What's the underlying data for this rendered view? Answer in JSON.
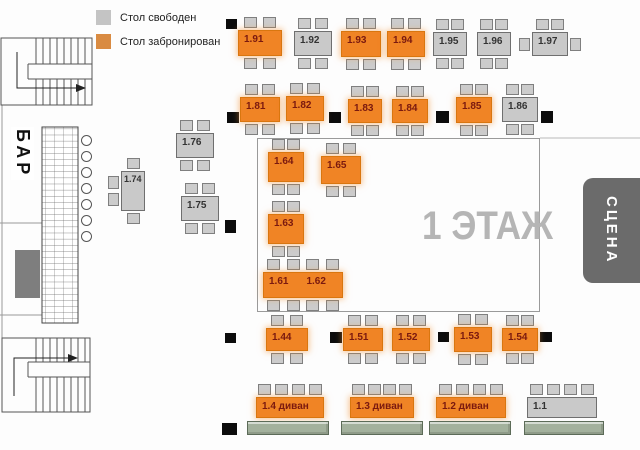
{
  "legend": {
    "free_label": "Стол свободен",
    "booked_label": "Стол забронирован"
  },
  "floor_label": "1 ЭТАЖ",
  "stage_label": "СЦЕНА",
  "bar": {
    "label": "БАР",
    "stool_x": 86,
    "stools": [
      140,
      156,
      172,
      188,
      204,
      220,
      236
    ]
  },
  "colors": {
    "booked_table": "#f08425",
    "free_table": "#c9c9c9",
    "legend_free": "#c4c4c4",
    "legend_booked": "#d98b42",
    "chair": "#cccccc",
    "pillar": "#0c0c0c",
    "stage_bg": "#6b6b6b",
    "stage_text": "#ffffff",
    "sofa": "#a3b19d",
    "floor_label_color": "#b5b5b5",
    "booked_label_text": "#7a190f",
    "free_label_text": "#333333"
  },
  "statuses": {
    "free": "free",
    "booked": "booked"
  },
  "tables": [
    {
      "label": "1.91",
      "status": "booked",
      "x": 238,
      "y": 30,
      "w": 44,
      "h": 26,
      "chairs": {
        "top": 2,
        "bottom": 2
      }
    },
    {
      "label": "1.92",
      "status": "free",
      "x": 294,
      "y": 31,
      "w": 38,
      "h": 25,
      "chairs": {
        "top": 2,
        "bottom": 2
      }
    },
    {
      "label": "1.93",
      "status": "booked",
      "x": 341,
      "y": 31,
      "w": 40,
      "h": 26,
      "chairs": {
        "top": 2,
        "bottom": 2
      }
    },
    {
      "label": "1.94",
      "status": "booked",
      "x": 387,
      "y": 31,
      "w": 38,
      "h": 26,
      "chairs": {
        "top": 2,
        "bottom": 2
      }
    },
    {
      "label": "1.95",
      "status": "free",
      "x": 433,
      "y": 32,
      "w": 34,
      "h": 24,
      "chairs": {
        "top": 2,
        "bottom": 2
      }
    },
    {
      "label": "1.96",
      "status": "free",
      "x": 477,
      "y": 32,
      "w": 34,
      "h": 24,
      "chairs": {
        "top": 2,
        "bottom": 2
      }
    },
    {
      "label": "1.97",
      "status": "free",
      "x": 532,
      "y": 32,
      "w": 36,
      "h": 24,
      "chairs": {
        "top": 2,
        "left": 1,
        "right": 1
      }
    },
    {
      "label": "1.81",
      "status": "booked",
      "x": 240,
      "y": 97,
      "w": 40,
      "h": 25,
      "chairs": {
        "top": 2,
        "bottom": 2
      }
    },
    {
      "label": "1.82",
      "status": "booked",
      "x": 286,
      "y": 96,
      "w": 38,
      "h": 25,
      "chairs": {
        "top": 2,
        "bottom": 2
      }
    },
    {
      "label": "1.83",
      "status": "booked",
      "x": 348,
      "y": 99,
      "w": 34,
      "h": 24,
      "chairs": {
        "top": 2,
        "bottom": 2
      }
    },
    {
      "label": "1.84",
      "status": "booked",
      "x": 392,
      "y": 99,
      "w": 36,
      "h": 24,
      "chairs": {
        "top": 2,
        "bottom": 2
      }
    },
    {
      "label": "1.85",
      "status": "booked",
      "x": 456,
      "y": 97,
      "w": 36,
      "h": 26,
      "chairs": {
        "top": 2,
        "bottom": 2
      }
    },
    {
      "label": "1.86",
      "status": "free",
      "x": 502,
      "y": 97,
      "w": 36,
      "h": 25,
      "chairs": {
        "top": 2,
        "bottom": 2
      }
    },
    {
      "label": "1.76",
      "status": "free",
      "x": 176,
      "y": 133,
      "w": 38,
      "h": 25,
      "chairs": {
        "top": 2,
        "bottom": 2
      }
    },
    {
      "label": "1.74",
      "status": "free",
      "x": 121,
      "y": 171,
      "w": 24,
      "h": 40,
      "chairs": {
        "top": 1,
        "bottom": 1,
        "left": 2
      }
    },
    {
      "label": "1.75",
      "status": "free",
      "x": 181,
      "y": 196,
      "w": 38,
      "h": 25,
      "chairs": {
        "top": 2,
        "bottom": 2
      }
    },
    {
      "label": "1.64",
      "status": "booked",
      "x": 268,
      "y": 152,
      "w": 36,
      "h": 30,
      "chairs": {
        "top": 2,
        "bottom": 2
      }
    },
    {
      "label": "1.65",
      "status": "booked",
      "x": 321,
      "y": 156,
      "w": 40,
      "h": 28,
      "chairs": {
        "top": 2,
        "bottom": 2
      }
    },
    {
      "label": "1.63",
      "status": "booked",
      "x": 268,
      "y": 214,
      "w": 36,
      "h": 30,
      "chairs": {
        "top": 2,
        "bottom": 2
      }
    },
    {
      "labels": [
        "1.61",
        "1.62"
      ],
      "status": "booked",
      "x": 263,
      "y": 272,
      "w": 80,
      "h": 26,
      "chairs": {
        "top": 4,
        "bottom": 4
      }
    },
    {
      "label": "1.44",
      "status": "booked",
      "x": 266,
      "y": 328,
      "w": 42,
      "h": 23,
      "chairs": {
        "top": 2,
        "bottom": 2
      }
    },
    {
      "label": "1.51",
      "status": "booked",
      "x": 343,
      "y": 328,
      "w": 40,
      "h": 23,
      "chairs": {
        "top": 2,
        "bottom": 2
      }
    },
    {
      "label": "1.52",
      "status": "booked",
      "x": 392,
      "y": 328,
      "w": 38,
      "h": 23,
      "chairs": {
        "top": 2,
        "bottom": 2
      }
    },
    {
      "label": "1.53",
      "status": "booked",
      "x": 454,
      "y": 327,
      "w": 38,
      "h": 25,
      "chairs": {
        "top": 2,
        "bottom": 2
      }
    },
    {
      "label": "1.54",
      "status": "booked",
      "x": 502,
      "y": 328,
      "w": 36,
      "h": 23,
      "chairs": {
        "top": 2,
        "bottom": 2
      }
    },
    {
      "label": "1.4 диван",
      "status": "booked",
      "x": 256,
      "y": 397,
      "w": 68,
      "h": 21,
      "chairs": {
        "top": 4
      },
      "sofa": {
        "x": 247,
        "y": 421,
        "w": 82,
        "h": 14
      }
    },
    {
      "label": "1.3 диван",
      "status": "booked",
      "x": 350,
      "y": 397,
      "w": 64,
      "h": 21,
      "chairs": {
        "top": 4
      },
      "sofa": {
        "x": 341,
        "y": 421,
        "w": 82,
        "h": 14
      }
    },
    {
      "label": "1.2 диван",
      "status": "booked",
      "x": 436,
      "y": 397,
      "w": 70,
      "h": 21,
      "chairs": {
        "top": 4
      },
      "sofa": {
        "x": 429,
        "y": 421,
        "w": 82,
        "h": 14
      }
    },
    {
      "label": "1.1",
      "status": "free",
      "x": 527,
      "y": 397,
      "w": 70,
      "h": 21,
      "chairs": {
        "top": 4
      },
      "sofa": {
        "x": 524,
        "y": 421,
        "w": 80,
        "h": 14
      }
    }
  ],
  "pillars": [
    {
      "x": 226,
      "y": 19,
      "w": 11,
      "h": 10
    },
    {
      "x": 227,
      "y": 112,
      "w": 12,
      "h": 11
    },
    {
      "x": 329,
      "y": 112,
      "w": 12,
      "h": 11
    },
    {
      "x": 436,
      "y": 111,
      "w": 13,
      "h": 12
    },
    {
      "x": 541,
      "y": 111,
      "w": 12,
      "h": 12
    },
    {
      "x": 225,
      "y": 220,
      "w": 11,
      "h": 13
    },
    {
      "x": 225,
      "y": 333,
      "w": 11,
      "h": 10
    },
    {
      "x": 330,
      "y": 332,
      "w": 12,
      "h": 11
    },
    {
      "x": 438,
      "y": 332,
      "w": 11,
      "h": 10
    },
    {
      "x": 540,
      "y": 332,
      "w": 12,
      "h": 10
    },
    {
      "x": 222,
      "y": 423,
      "w": 15,
      "h": 12
    }
  ]
}
